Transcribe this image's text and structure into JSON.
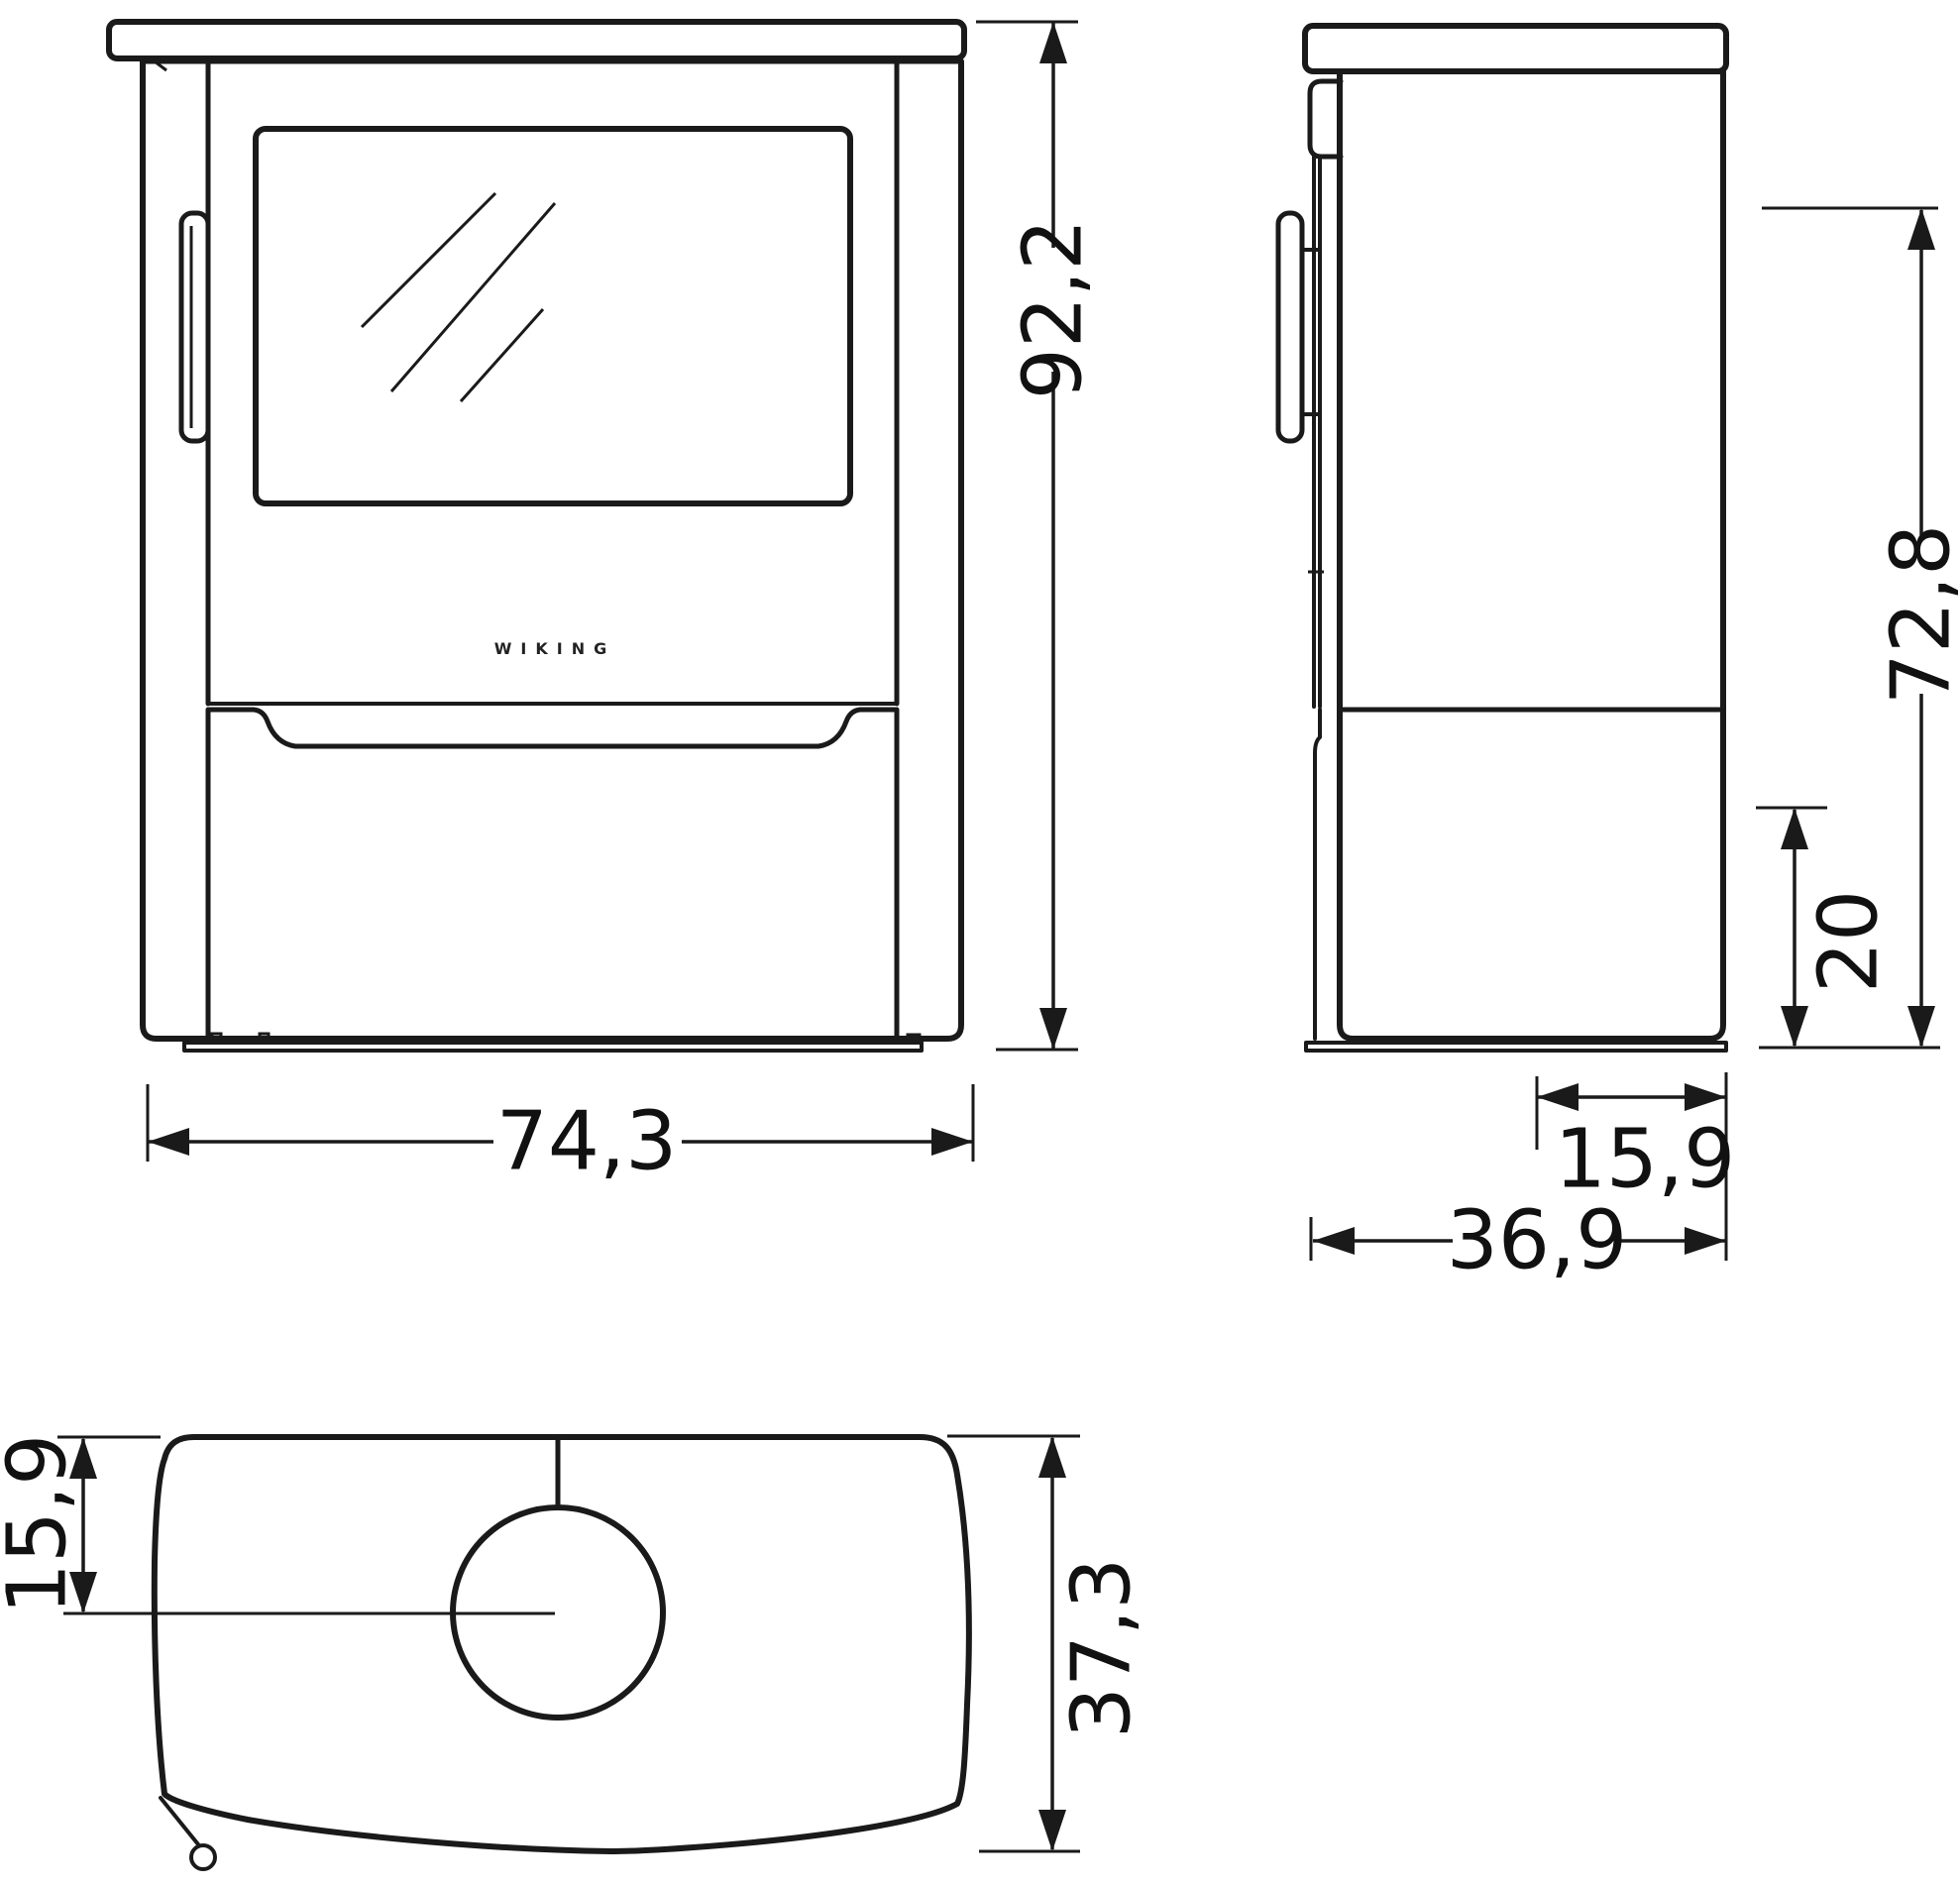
{
  "drawing": {
    "brand": "WIKING",
    "line_color": "#1a1a1a",
    "background": "#ffffff",
    "front_view": {
      "height": "92,2",
      "width": "74,3"
    },
    "side_view": {
      "flue_outlet_height": "72,8",
      "lower_section_height": "20",
      "flue_center_from_back": "15,9",
      "depth": "36,9"
    },
    "top_view": {
      "flue_center_from_back": "15,9",
      "depth": "37,3"
    }
  }
}
